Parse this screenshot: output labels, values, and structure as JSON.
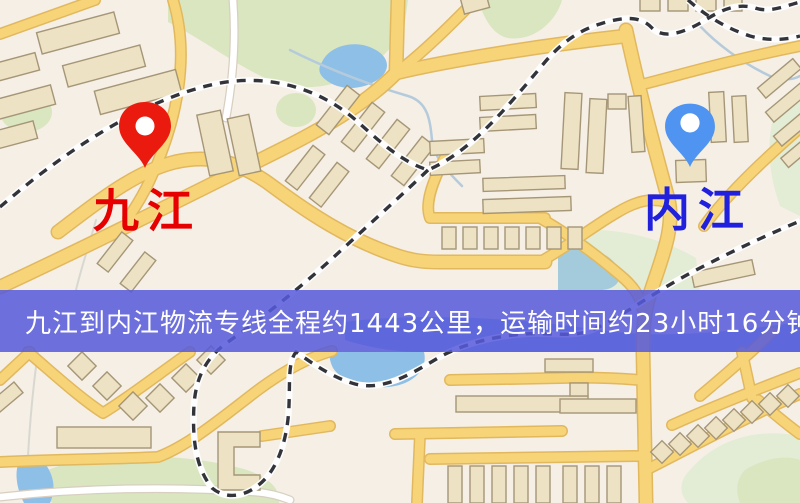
{
  "map": {
    "origin_label": "九江",
    "destination_label": "内江",
    "origin_pin": "red-location-pin",
    "destination_pin": "blue-location-pin"
  },
  "banner": {
    "text": "九江到内江物流专线全程约1443公里，运输时间约23小时16分钟."
  },
  "colors": {
    "bg": "#f5efe6",
    "park": "#d9e6c0",
    "park2": "#e3ecd4",
    "water": "#8ebfe6",
    "water2": "#a3cbdc",
    "stream": "#b5cbdc",
    "road_fill": "#f7d478",
    "road_case": "#e2b85e",
    "wroad": "#ffffff",
    "wroad_case": "#d8cfc0",
    "bld_fill": "#ede2c3",
    "bld_stroke": "#a59677",
    "rail": "#33343a",
    "origin_pin_color": "#ea1a0f",
    "destination_pin_color": "#4f94f0",
    "origin_label_color": "#e60000",
    "destination_label_color": "#2121dd",
    "banner_bg": "#565ada",
    "banner_text_color": "#ffffff"
  }
}
